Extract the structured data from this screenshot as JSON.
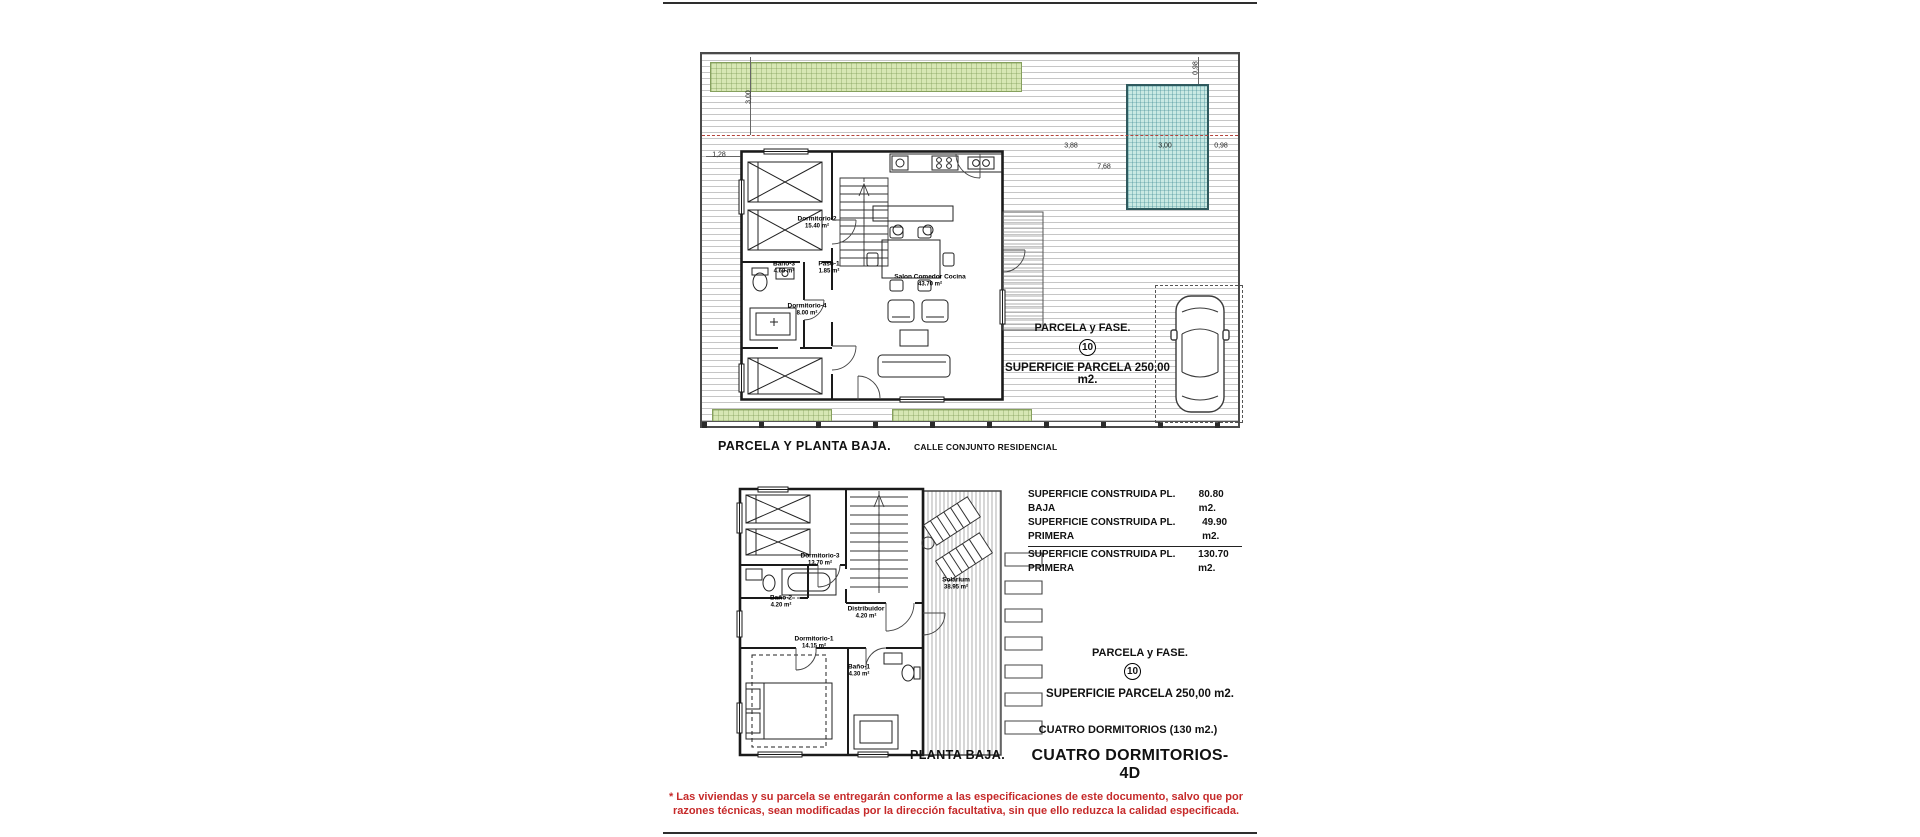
{
  "site_plan": {
    "title": "PARCELA Y PLANTA BAJA.",
    "street": "CALLE CONJUNTO RESIDENCIAL",
    "parcel_label": "PARCELA y FASE.",
    "parcel_number": "10",
    "parcel_area": "SUPERFICIE PARCELA 250,00 m2.",
    "rooms": {
      "dorm2": {
        "name": "Dormitorio-2",
        "area": "15.40 m²"
      },
      "bano3": {
        "name": "Baño-3",
        "area": "4.60 m²"
      },
      "paso1": {
        "name": "Paso-1",
        "area": "1.85 m²"
      },
      "dorm4": {
        "name": "Dormitorio-4",
        "area": "8.00 m²"
      },
      "salon": {
        "name": "Salon  Comedor  Cocina",
        "area": "43.70 m²"
      }
    },
    "dims": {
      "d128": "1,28",
      "d300v": "3,00",
      "d388": "3,88",
      "d300": "3,00",
      "d098": "0,98",
      "d768": "7,68",
      "d098v": "0,98"
    }
  },
  "floor_plan": {
    "title": "PLANTA BAJA.",
    "rooms": {
      "dorm3": {
        "name": "Dormitorio-3",
        "area": "13.70 m²"
      },
      "bano2": {
        "name": "Baño-2",
        "area": "4.20 m²"
      },
      "distribuidor": {
        "name": "Distribuidor",
        "area": "4.20 m²"
      },
      "dorm1": {
        "name": "Dormitorio-1",
        "area": "14.15 m²"
      },
      "bano1": {
        "name": "Baño-1",
        "area": "4.30 m²"
      },
      "solarium": {
        "name": "Solarium",
        "area": "38.95 m²"
      }
    }
  },
  "summary": {
    "rows": [
      {
        "label": "SUPERFICIE CONSTRUIDA PL. BAJA",
        "value": "80.80 m2."
      },
      {
        "label": "SUPERFICIE CONSTRUIDA PL. PRIMERA",
        "value": "49.90 m2."
      },
      {
        "label": "SUPERFICIE CONSTRUIDA PL. PRIMERA",
        "value": "130.70 m2."
      }
    ]
  },
  "info": {
    "parcel_label": "PARCELA y FASE.",
    "parcel_number": "10",
    "parcel_area": "SUPERFICIE PARCELA 250,00 m2.",
    "bedrooms": "CUATRO DORMITORIOS (130 m2.)",
    "type_code": "CUATRO DORMITORIOS- 4D"
  },
  "disclaimer": "* Las viviendas y su parcela se entregarán conforme a las especificaciones de este documento, salvo que por\nrazones técnicas, sean modificadas por la dirección facultativa, sin que ello reduzca la calidad especificada."
}
